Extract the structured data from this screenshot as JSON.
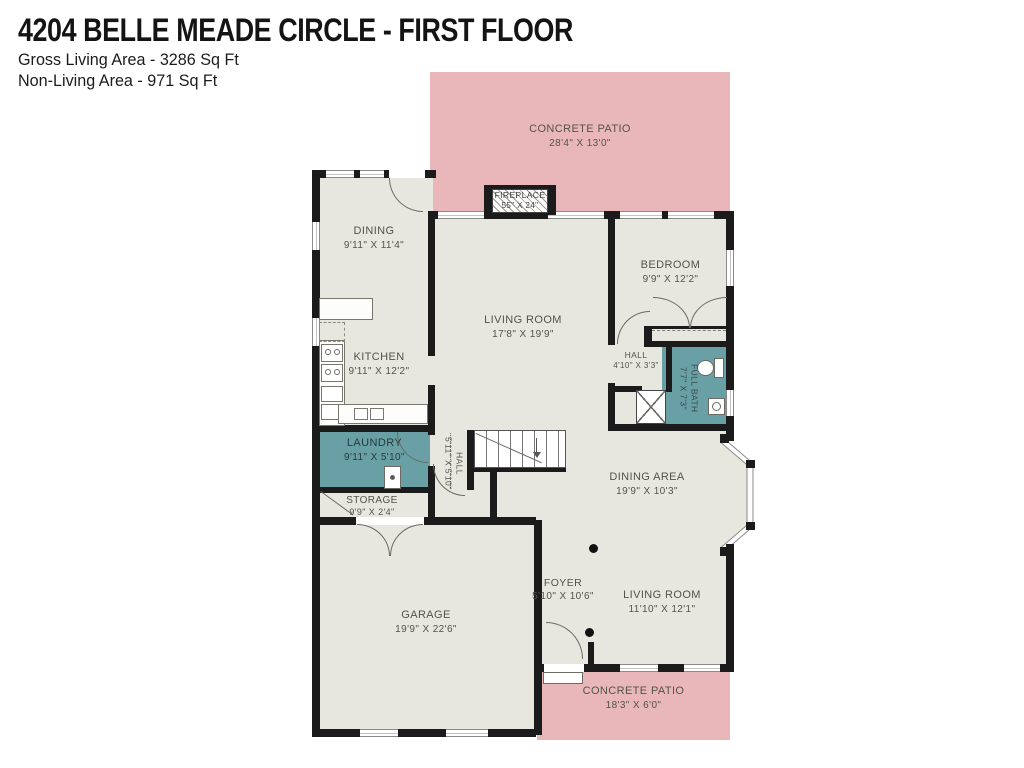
{
  "header": {
    "title": "4204 BELLE MEADE CIRCLE - FIRST FLOOR",
    "gross_living": "Gross Living Area - 3286 Sq Ft",
    "non_living": "Non-Living Area - 971 Sq Ft"
  },
  "colors": {
    "patio": "#e9b7b9",
    "floor": "#e8e7df",
    "wet_room_teal": "#69a0a6",
    "wall": "#1b1b1b",
    "label_text": "#53534a"
  },
  "rooms": {
    "patio_top": {
      "name": "CONCRETE PATIO",
      "dims": "28'4\" X 13'0\""
    },
    "dining": {
      "name": "DINING",
      "dims": "9'11\" X 11'4\""
    },
    "fireplace": {
      "name": "FIREPLACE",
      "dims": "55\" X 24\""
    },
    "living_room": {
      "name": "LIVING ROOM",
      "dims": "17'8\" X 19'9\""
    },
    "bedroom": {
      "name": "BEDROOM",
      "dims": "9'9\" X 12'2\""
    },
    "kitchen": {
      "name": "KITCHEN",
      "dims": "9'11\" X 12'2\""
    },
    "hall": {
      "name": "HALL",
      "dims": "4'10\" X 3'3\""
    },
    "full_bath": {
      "name": "FULL BATH",
      "dims": "7'7\" X 7'3\""
    },
    "laundry": {
      "name": "LAUNDRY",
      "dims": "9'11\" X 5'10\""
    },
    "hall_stairs": {
      "name": "HALL",
      "dims": "5'11\" X 5'10\""
    },
    "storage": {
      "name": "STORAGE",
      "dims": "9'9\" X 2'4\""
    },
    "dining_area": {
      "name": "DINING AREA",
      "dims": "19'9\" X 10'3\""
    },
    "garage": {
      "name": "GARAGE",
      "dims": "19'9\" X 22'6\""
    },
    "foyer": {
      "name": "FOYER",
      "dims": "5'10\" X 10'6\""
    },
    "living_room_2": {
      "name": "LIVING ROOM",
      "dims": "11'10\" X 12'1\""
    },
    "patio_bottom": {
      "name": "CONCRETE PATIO",
      "dims": "18'3\" X 6'0\""
    }
  }
}
